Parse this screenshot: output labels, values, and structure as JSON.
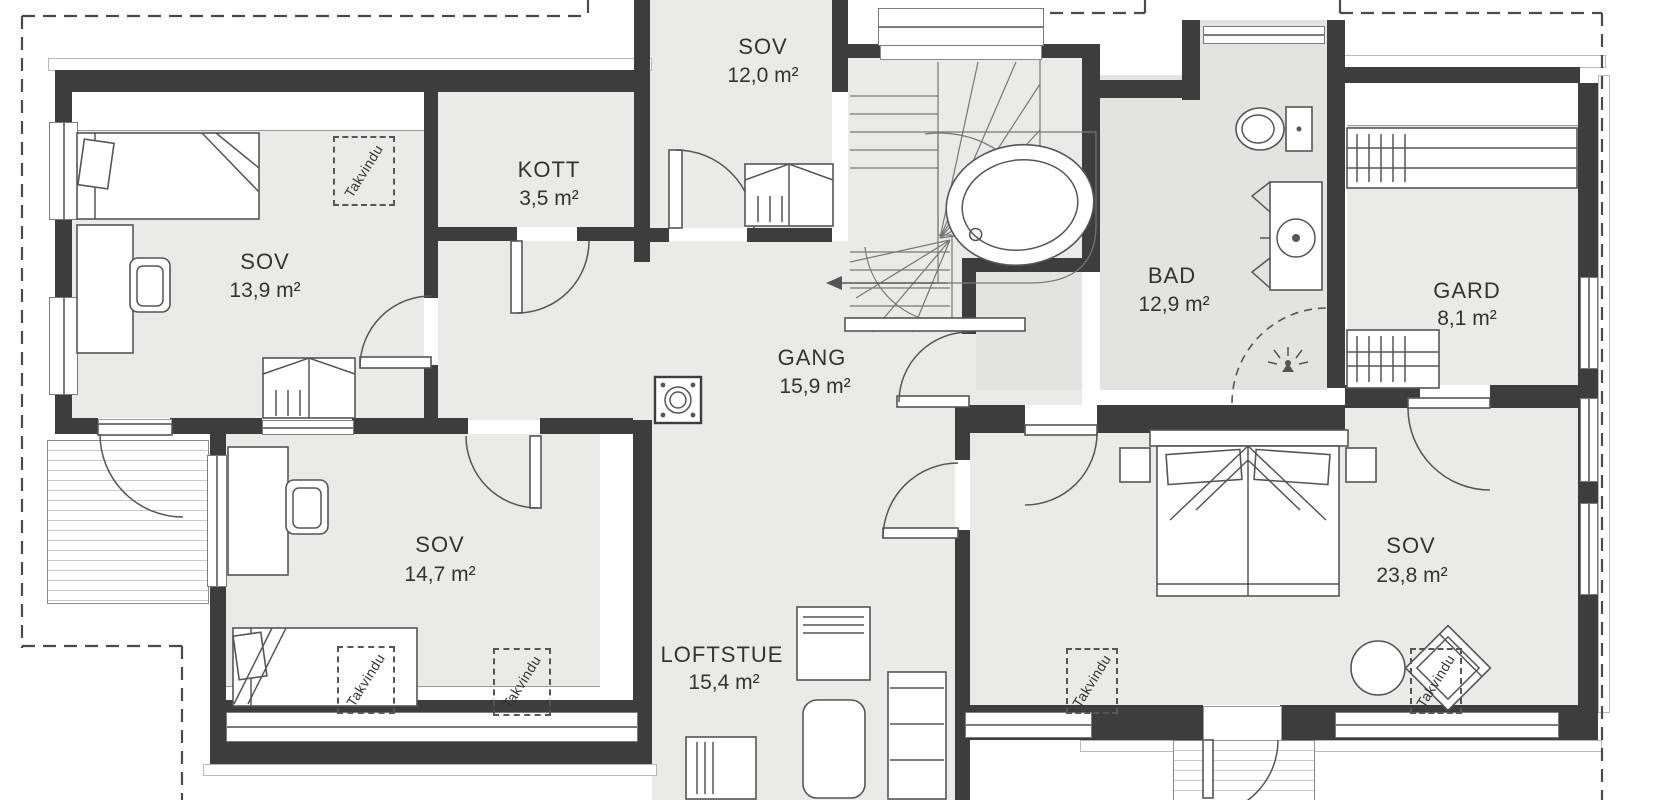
{
  "colors": {
    "wall": "#3d3d3d",
    "floor": "#eaeae8",
    "floor-bad": "#e3e3e1",
    "line": "#555555",
    "line-light": "#999999",
    "dash": "#4a4a4a",
    "text": "#333333"
  },
  "rooms": {
    "sov_top": {
      "name": "SOV",
      "area": "12,0 m²"
    },
    "kott": {
      "name": "KOTT",
      "area": "3,5 m²"
    },
    "sov_left": {
      "name": "SOV",
      "area": "13,9 m²"
    },
    "gang": {
      "name": "GANG",
      "area": "15,9 m²"
    },
    "bad": {
      "name": "BAD",
      "area": "12,9 m²"
    },
    "gard": {
      "name": "GARD",
      "area": "8,1 m²"
    },
    "sov_bottom_left": {
      "name": "SOV",
      "area": "14,7 m²"
    },
    "loftstue": {
      "name": "LOFTSTUE",
      "area": "15,4 m²"
    },
    "sov_master": {
      "name": "SOV",
      "area": "23,8 m²"
    }
  },
  "labels": {
    "roof_window": "Takvindu"
  }
}
